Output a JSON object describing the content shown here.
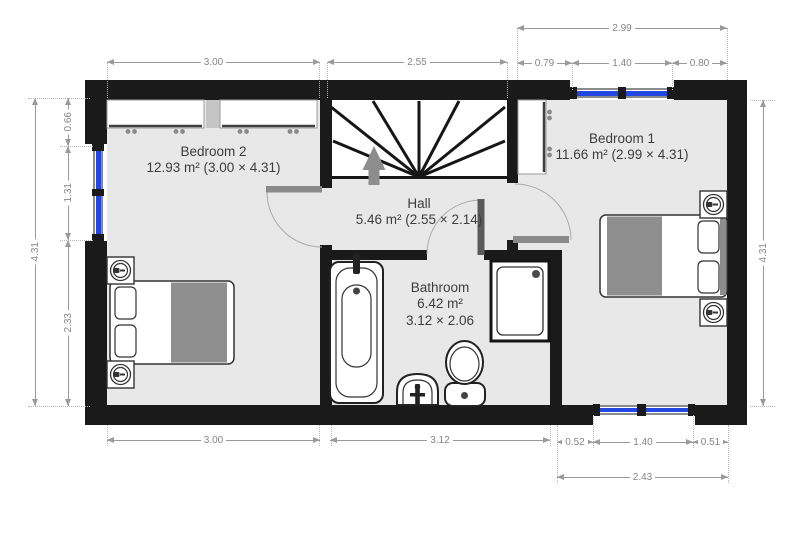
{
  "plan": {
    "rooms": {
      "bedroom2": {
        "name": "Bedroom 2",
        "details": "12.93 m² (3.00 × 4.31)"
      },
      "bedroom1": {
        "name": "Bedroom 1",
        "details": "11.66 m² (2.99 × 4.31)"
      },
      "hall": {
        "name": "Hall",
        "details": "5.46 m² (2.55 × 2.14)"
      },
      "bathroom": {
        "name": "Bathroom",
        "area": "6.42 m²",
        "size": "3.12 × 2.06"
      }
    },
    "dimensions": {
      "top": {
        "bedroom2_width": "3.00",
        "hall_width": "2.55",
        "bedroom1_total": "2.99",
        "bedroom1_left": "0.79",
        "bedroom1_window": "1.40",
        "bedroom1_right": "0.80"
      },
      "left": {
        "upper": "0.66",
        "window": "1.31",
        "lower": "2.33",
        "total": "4.31"
      },
      "bottom": {
        "bedroom2_width": "3.00",
        "bathroom_width": "3.12",
        "bedroom1_left": "0.52",
        "bedroom1_window": "1.40",
        "bedroom1_right": "0.51",
        "bedroom1_total": "2.43"
      },
      "right": {
        "total": "4.31"
      }
    },
    "fixtures": [
      "winder-staircase",
      "direction-arrow",
      "door",
      "double-bed",
      "pillow",
      "blanket",
      "nightstand-lamp",
      "wardrobe",
      "bathtub",
      "washbasin",
      "toilet",
      "shower-tray",
      "window"
    ],
    "colors": {
      "wall": "#1a1a1a",
      "floor": "#e8e8e8",
      "window_glass": "#2247e0",
      "door_leaf": "#8a8a8a",
      "blanket": "#8f8f8f",
      "dimension": "#9a9a9a",
      "label_text": "#3d3d3d"
    }
  }
}
